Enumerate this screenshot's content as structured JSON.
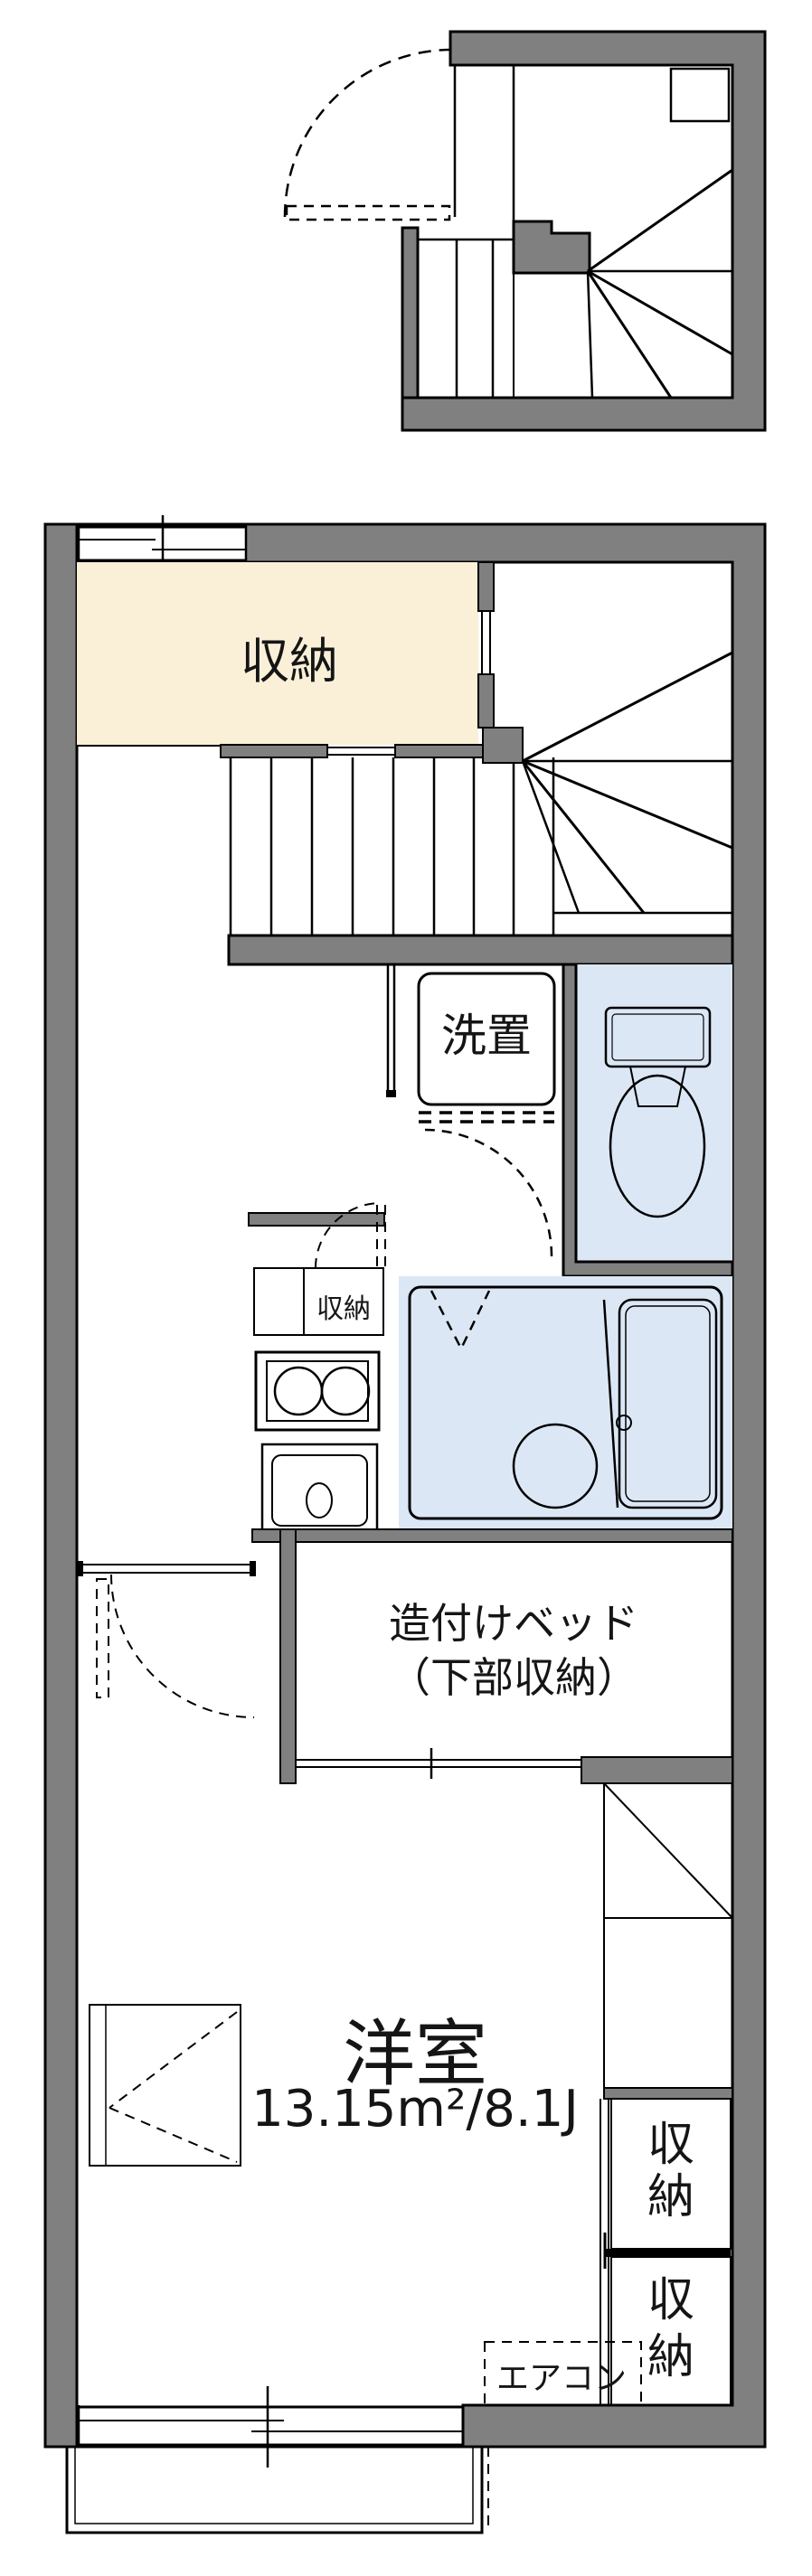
{
  "document": {
    "type": "apartment-floor-plan",
    "floors": [
      "entry-stair-section",
      "main-unit"
    ]
  },
  "colors": {
    "wall": "#808080",
    "beige": "#FAF0D8",
    "blue": "#DCE7F6",
    "line": "#000000",
    "text": "#151515"
  },
  "labels": {
    "storage_main": "収納",
    "laundry": "洗置",
    "storage_kitchen": "収納",
    "bed_line1": "造付けベッド",
    "bed_line2": "（下部収納）",
    "room_name": "洋室",
    "room_area": "13.15m²/8.1J",
    "aircon": "エアコン",
    "closet_upper_char1": "収",
    "closet_upper_char2": "納",
    "closet_lower_char1": "収",
    "closet_lower_char2": "納"
  },
  "rooms": [
    {
      "name": "storage",
      "label": "収納"
    },
    {
      "name": "stairs",
      "label": ""
    },
    {
      "name": "laundry-space",
      "label": "洗置"
    },
    {
      "name": "toilet",
      "label": ""
    },
    {
      "name": "kitchen-storage",
      "label": "収納"
    },
    {
      "name": "bathroom",
      "label": ""
    },
    {
      "name": "built-in-bed",
      "label": "造付けベッド（下部収納）"
    },
    {
      "name": "western-room",
      "label": "洋室",
      "area": "13.15m²/8.1J"
    },
    {
      "name": "air-conditioner",
      "label": "エアコン"
    },
    {
      "name": "closet-upper",
      "label": "収納"
    },
    {
      "name": "closet-lower",
      "label": "収納"
    }
  ]
}
